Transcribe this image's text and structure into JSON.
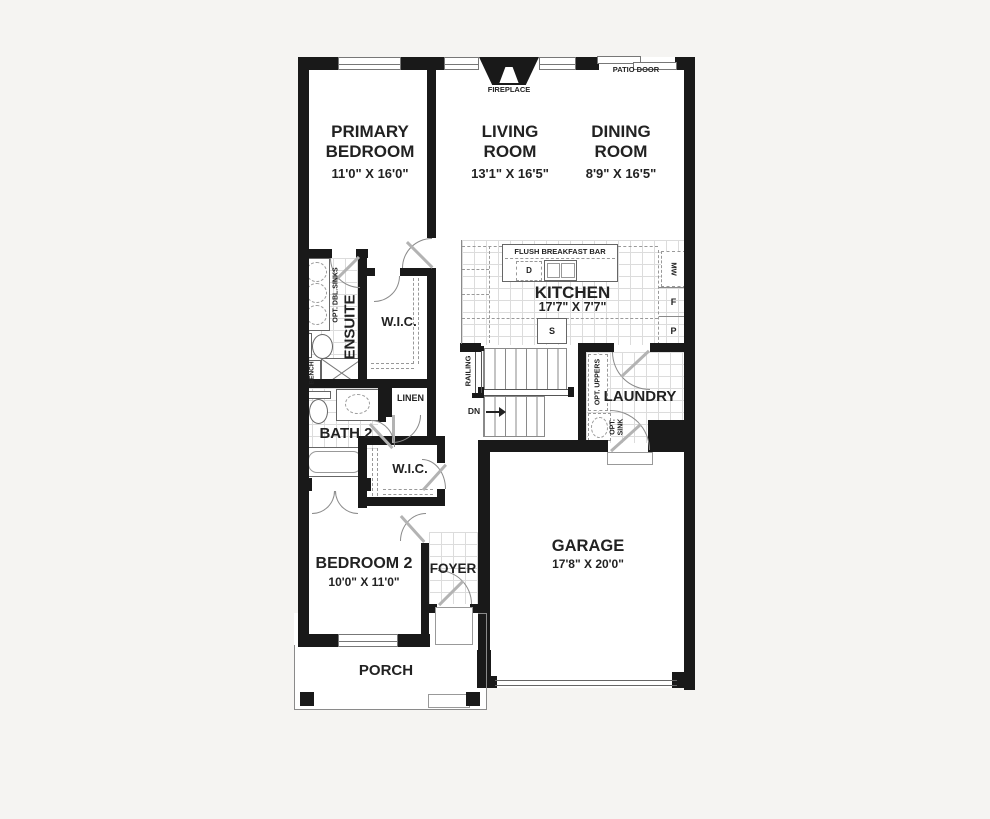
{
  "colors": {
    "background": "#f5f4f2",
    "wall": "#191919",
    "line": "#8a8a8a",
    "tile": "#dcdcdc",
    "text": "#222222"
  },
  "rooms": {
    "primary_bedroom": {
      "name": "PRIMARY BEDROOM",
      "dims": "11'0\" X 16'0\""
    },
    "living_room": {
      "name": "LIVING ROOM",
      "dims": "13'1\" X 16'5\""
    },
    "dining_room": {
      "name": "DINING ROOM",
      "dims": "8'9\" X 16'5\""
    },
    "kitchen": {
      "name": "KITCHEN",
      "dims": "17'7\" X 7'7\""
    },
    "ensuite": {
      "name": "ENSUITE"
    },
    "wic_primary": {
      "name": "W.I.C."
    },
    "bath_2": {
      "name": "BATH 2"
    },
    "wic_bedroom2": {
      "name": "W.I.C."
    },
    "laundry": {
      "name": "LAUNDRY"
    },
    "bedroom_2": {
      "name": "BEDROOM 2",
      "dims": "10'0\" X 11'0\""
    },
    "foyer": {
      "name": "FOYER"
    },
    "garage": {
      "name": "GARAGE",
      "dims": "17'8\" X 20'0\""
    },
    "porch": {
      "name": "PORCH"
    },
    "linen": {
      "name": "LINEN"
    }
  },
  "labels": {
    "fireplace": "FIREPLACE",
    "patio_door": "PATIO DOOR",
    "flush_breakfast_bar": "FLUSH BREAKFAST BAR",
    "railing": "RAILING",
    "down": "DN",
    "bench": "BENCH",
    "opt_dbl_sinks": "OPT. DBL.SINKS",
    "opt_uppers": "OPT. UPPERS",
    "opt_sink": "OPT. SINK",
    "dishwasher": "D",
    "stove": "S",
    "microwave": "MW",
    "fridge": "F",
    "pantry": "P"
  }
}
